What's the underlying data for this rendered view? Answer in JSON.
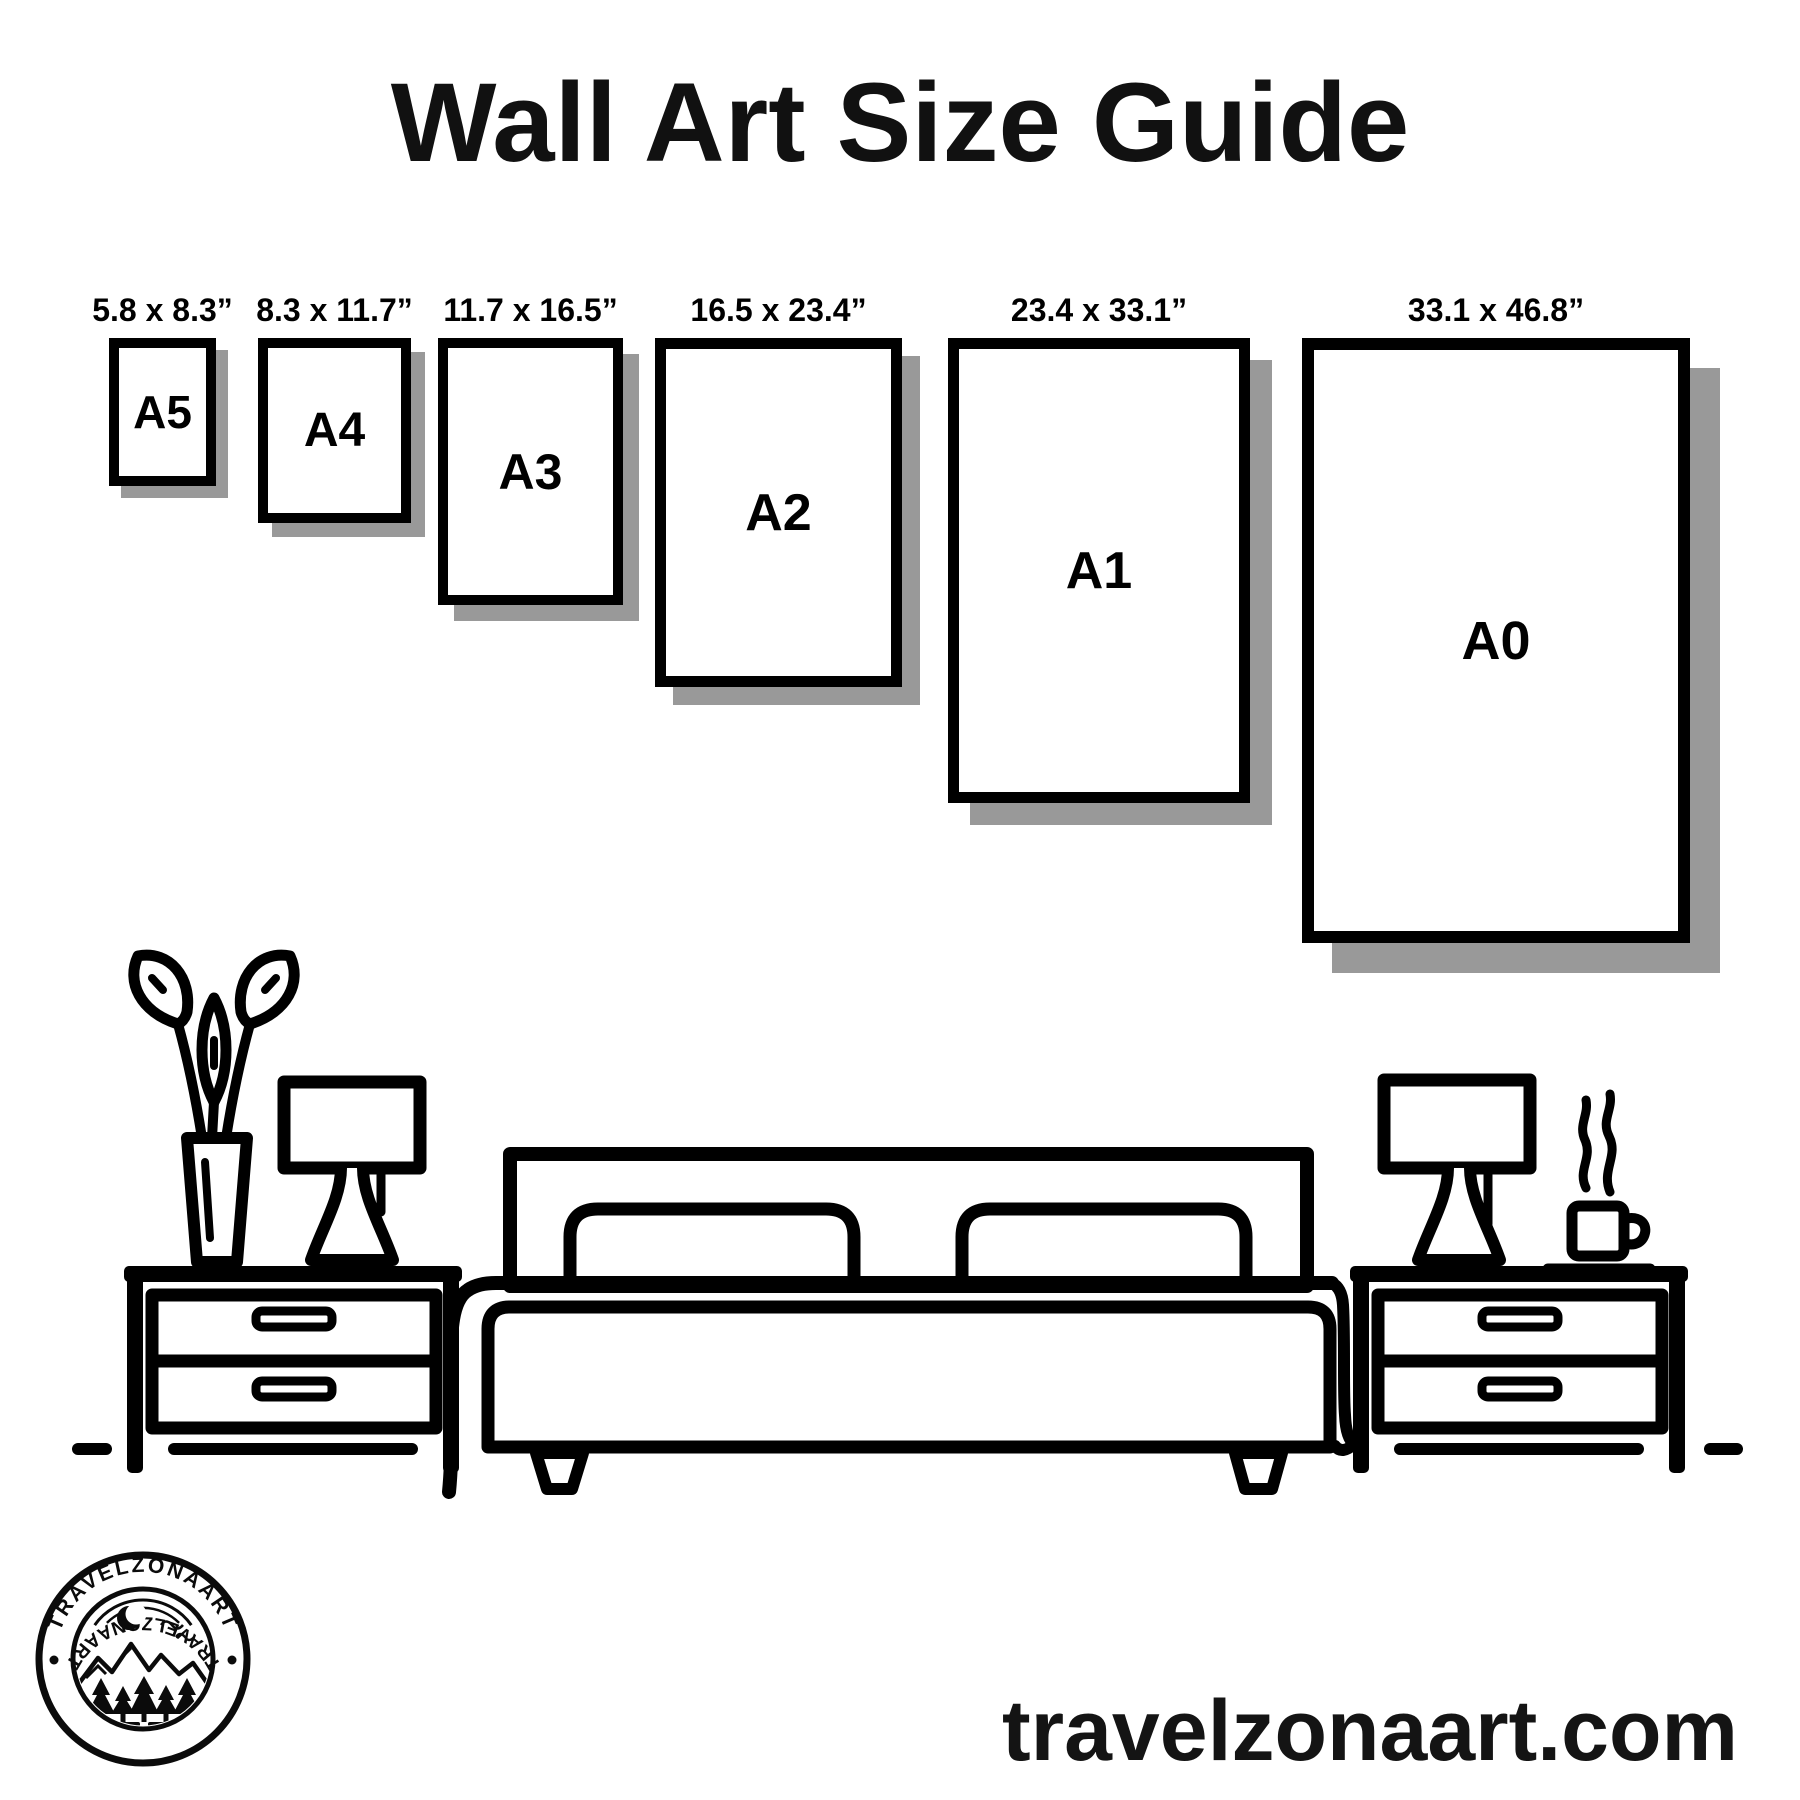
{
  "page": {
    "title": "Wall Art Size Guide"
  },
  "colors": {
    "ink": "#000000",
    "background": "#ffffff",
    "shadow": "#999999"
  },
  "size_guide": {
    "frames": [
      {
        "letter": "A5",
        "size_label": "5.8 x 8.3”"
      },
      {
        "letter": "A4",
        "size_label": "8.3 x 11.7”"
      },
      {
        "letter": "A3",
        "size_label": "11.7 x 16.5”"
      },
      {
        "letter": "A2",
        "size_label": "16.5 x 23.4”"
      },
      {
        "letter": "A1",
        "size_label": "23.4 x 33.1”"
      },
      {
        "letter": "A0",
        "size_label": "33.1 x 46.8”"
      }
    ]
  },
  "illustration": {
    "icons": [
      "plant-vase-icon",
      "table-lamp-icon",
      "nightstand-icon",
      "double-bed-icon",
      "pillow-icon",
      "coffee-cup-icon",
      "steam-icon",
      "floor-line-icon"
    ]
  },
  "logo": {
    "brand_top": "TRAVELZONAART",
    "brand_bottom": "TRAVELZONAART"
  },
  "footer": {
    "website": "travelzonaart.com"
  }
}
